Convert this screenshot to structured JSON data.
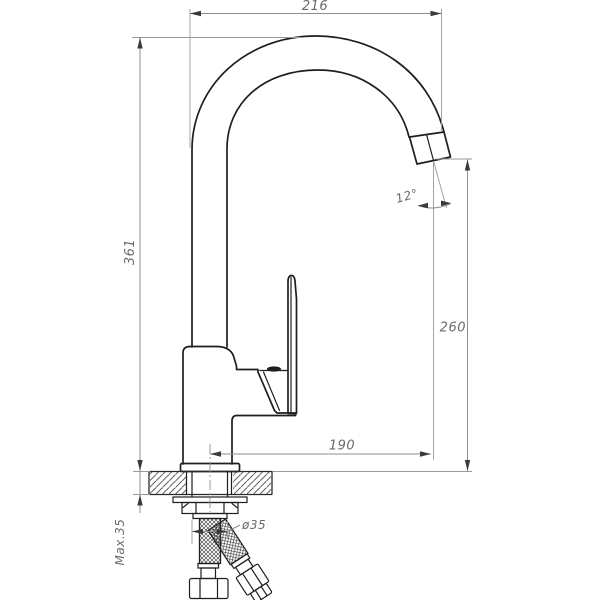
{
  "drawing": {
    "type": "technical-dimension-drawing",
    "subject": "single-lever high-arc kitchen mixer faucet, side elevation with counter mounting cross-section and flexible supply hoses",
    "units": "mm",
    "labels": {
      "width_top": "216",
      "height_left": "361",
      "spout_height_right": "260",
      "spout_reach_bottom": "190",
      "hole_diameter": "ø35",
      "max_mounting_thickness": "Max.35",
      "spout_angle": "12°"
    },
    "colors": {
      "background": "#ffffff",
      "outline": "#1f1f1f",
      "dimension_lines": "#8f8f8f",
      "dimension_text": "#6b6b6b"
    }
  }
}
